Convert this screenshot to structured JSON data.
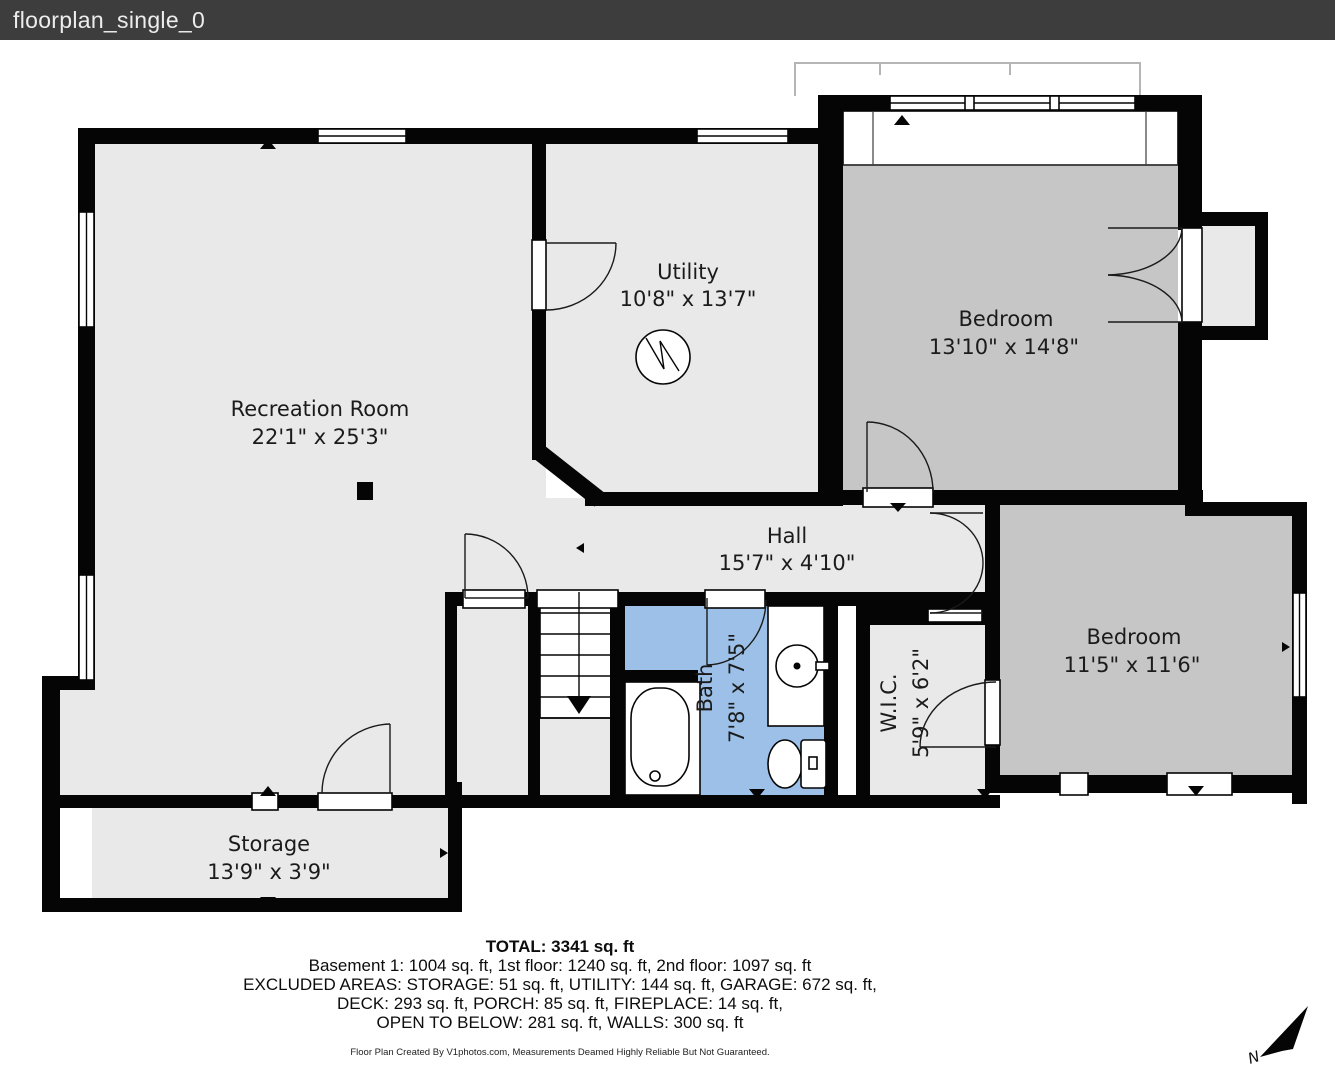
{
  "title_bar": {
    "title": "floorplan_single_0"
  },
  "rooms": {
    "recreation": {
      "name": "Recreation Room",
      "dims": "22'1\" x 25'3\""
    },
    "utility": {
      "name": "Utility",
      "dims": "10'8\" x 13'7\""
    },
    "bedroom1": {
      "name": "Bedroom",
      "dims": "13'10\" x 14'8\""
    },
    "hall": {
      "name": "Hall",
      "dims": "15'7\" x 4'10\""
    },
    "bath": {
      "name": "Bath",
      "dims": "7'8\" x 7'5\""
    },
    "wic": {
      "name": "W.I.C.",
      "dims": "5'9\" x 6'2\""
    },
    "bedroom2": {
      "name": "Bedroom",
      "dims": "11'5\" x 11'6\""
    },
    "storage": {
      "name": "Storage",
      "dims": "13'9\" x 3'9\""
    }
  },
  "summary": {
    "total": "TOTAL: 3341 sq. ft",
    "lines": [
      "Basement 1: 1004 sq. ft, 1st floor: 1240 sq. ft, 2nd floor: 1097 sq. ft",
      "EXCLUDED AREAS: STORAGE: 51 sq. ft, UTILITY: 144 sq. ft, GARAGE: 672 sq. ft,",
      "DECK: 293 sq. ft, PORCH: 85 sq. ft, FIREPLACE: 14 sq. ft,",
      "OPEN TO BELOW: 281 sq. ft, WALLS: 300 sq. ft"
    ]
  },
  "footer": "Floor Plan Created By V1photos.com, Measurements Deamed Highly Reliable But Not Guaranteed.",
  "compass": {
    "label": "N"
  },
  "colors": {
    "title_bar_bg": "#3d3d3d",
    "wall": "#050505",
    "room_light": "#e9e9e9",
    "room_dark": "#c6c6c6",
    "bath_blue": "#9cc0e8"
  }
}
